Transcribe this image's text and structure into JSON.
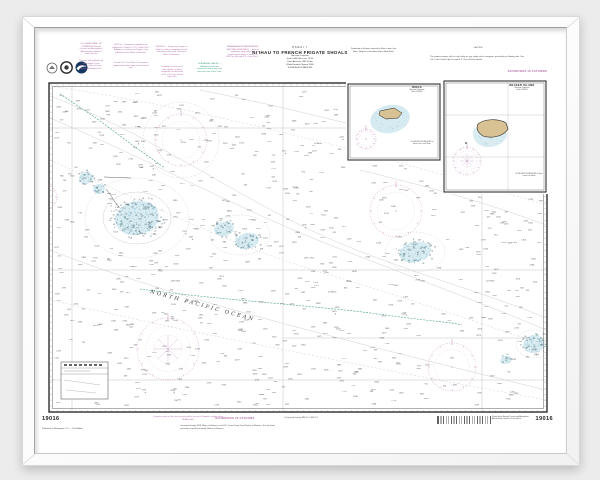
{
  "chart": {
    "number": "19016"
  },
  "labels": {
    "soundings": "SOUNDINGS IN FATHOMS"
  },
  "title_block": {
    "region": "HAWAI'I",
    "title": "NI'IHAU TO FRENCH FRIGATE SHOALS",
    "lines": [
      "Mercator Projection",
      "Scale 1:600,000 at Lat. 23°30'",
      "North American 1983 Datum",
      "(World Geodetic System 1984)",
      "SOUNDINGS IN FATHOMS"
    ]
  },
  "notes": {
    "dept": "U.S. DEPARTMENT OF COMMERCE National Oceanic and Atmospheric Administration National Ocean Service",
    "agency": "Prepared and published by the National Ocean Service, Office of Coast Survey, Washington D.C.",
    "note_a": "NOTE A — Navigation regulations are published in Chapter 2, U.S. Coast Pilot 7. Additions or revisions to Chapter 2 are published in the Notice to Mariners.",
    "note_a2": "Consult U.S. Coast Pilot 7 for important supplemental information concerning this area.",
    "caution": "CAUTION — Temporary changes or defects in aids to navigation are not indicated on this chart. See Local Notice to Mariners.",
    "radio": "Limitations on the use of radio signals as aids to navigation can be found in the U.S. Coast Guard Light Lists.",
    "cables": "SUBMARINE CABLES — Additional uncharted submarine cables may exist within the area of this chart.",
    "monument": "PAPAHANAUMOKUAKEA MARINE NATIONAL MONUMENT — Special regulations apply within the monument boundary. Consult 50 CFR Part 404 and U.S. Coast Pilot 7.",
    "sound_note": "Soundings in fathoms reduced to Mean Lower Low Water. Heights in feet above Mean High Water.",
    "caution_right_head": "CAUTION",
    "caution_right": "The prudent mariner will not rely solely on any single aid to navigation, particularly on floating aids. See U.S. Coast Guard Light List and U.S. Coast Pilot for details."
  },
  "bottom": {
    "edition": "Published at Washington, D.C. — 21st Edition",
    "purple_note": "Compass roses on this chart are oriented to true north. Magnetic variation from NOAA model.",
    "bracket": "( Corrected through NM 25  •  LNM 22 )",
    "corrections": "Corrected through NOS Notice to Mariners and U.S. Coast Guard Local Notice to Mariners. For the latest corrections consult the weekly Notice to Mariners.",
    "printer": "Printed by the National Oceanic and Atmospheric Administration, National Ocean Service"
  },
  "insets": [
    {
      "title": "NIHOA",
      "subtitle": "Mercator Projection",
      "scale": "Scale 1:80,000",
      "note": "SOUNDINGS IN FATHOMS at Mean Lower Low Water"
    },
    {
      "title": "NECKER ISLAND",
      "subtitle": "Mercator Projection",
      "scale": "Scale 1:80,000",
      "note": "SOUNDINGS IN FATHOMS at Mean Lower Low Water"
    }
  ],
  "ocean_label": "NORTH PACIFIC OCEAN",
  "soundings": {
    "seed": 11,
    "count": 620,
    "min": 420,
    "max": 2980
  },
  "colors": {
    "magenta": "#c791bd",
    "green": "#4aa183",
    "shallow": "#cfe7ef",
    "speck": "#7fb6c9",
    "land": "#d8c294",
    "contour": "#d0d0d0"
  }
}
